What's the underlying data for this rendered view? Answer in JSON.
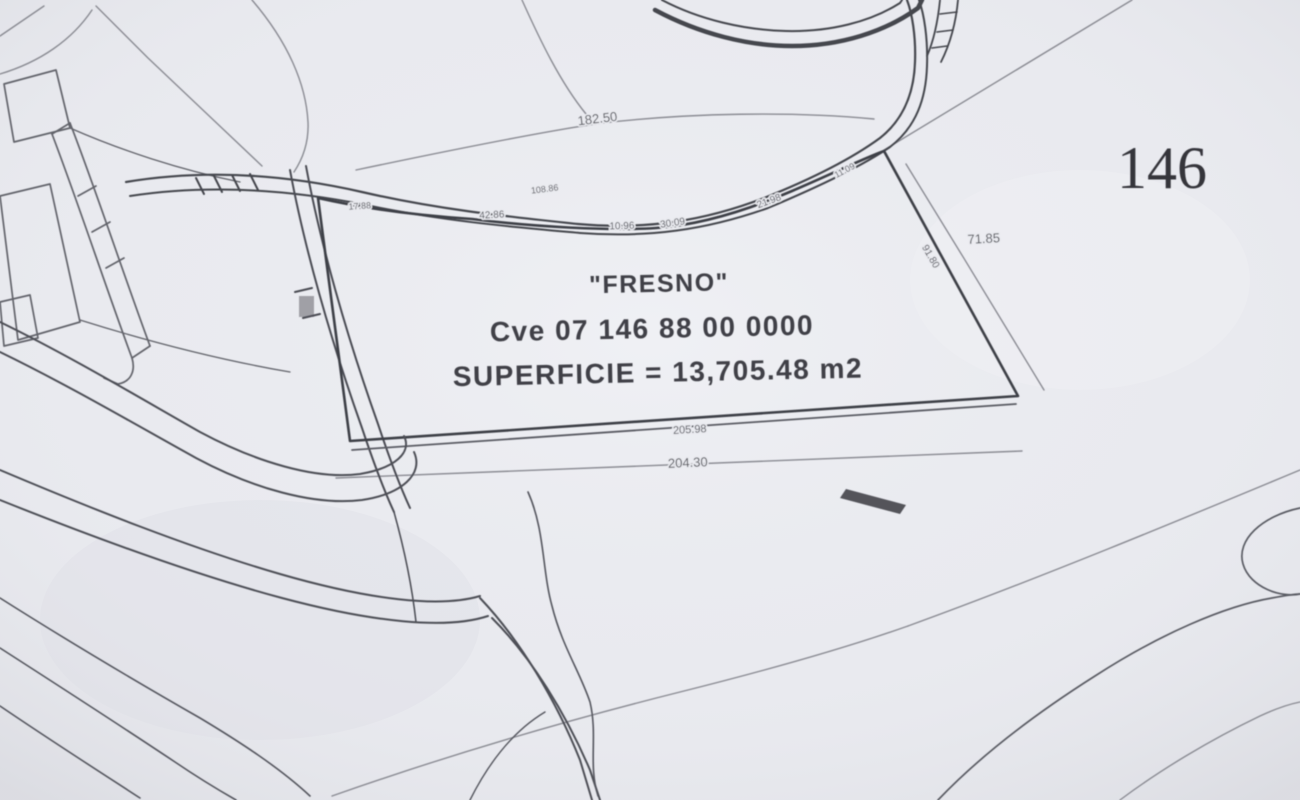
{
  "map": {
    "type": "scanned cadastral survey plan",
    "sheet_number": "146",
    "parcel": {
      "name_label": "\"FRESNO\"",
      "clave_label": "Cve 07 146 88 00 0000",
      "superficie_label": "SUPERFICIE = 13,705.48 m2"
    },
    "dimensions": {
      "top": "182.50",
      "right": "71.85",
      "right_edge": "91.80",
      "bottom_inner": "205.98",
      "bottom": "204.30",
      "edge_labels": [
        "17.88",
        "42.86",
        "108.86",
        "10.96",
        "30.09",
        "21.98",
        "11.09"
      ]
    },
    "colors": {
      "paper": "#e9eaef",
      "ink_dark": "#45464d",
      "ink_light": "#85868e"
    }
  }
}
